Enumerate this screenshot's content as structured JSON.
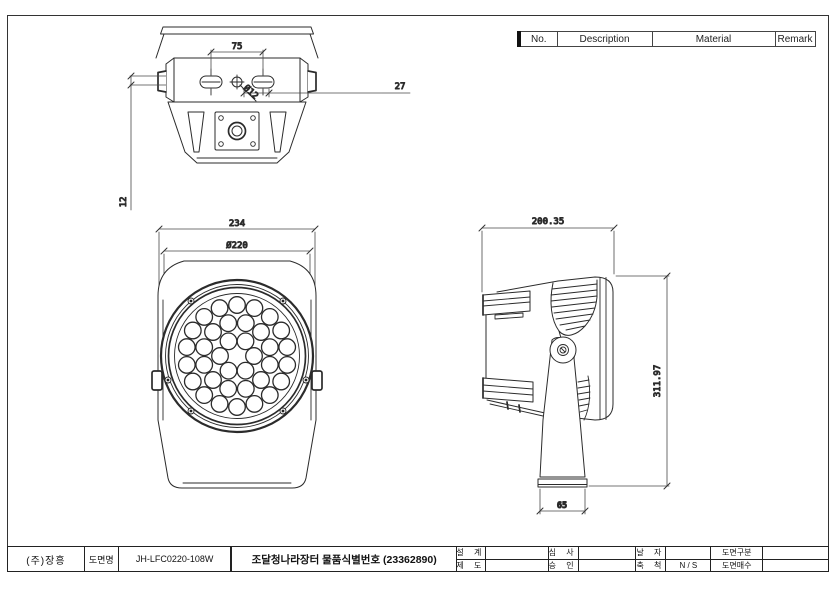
{
  "colors": {
    "line": "#2b2b2b",
    "text": "#111111",
    "background": "#ffffff"
  },
  "spec_table": {
    "columns": [
      "No.",
      "Description",
      "Material",
      "Remark"
    ],
    "rows": [
      {
        "no": "1",
        "description": "Lighting Source",
        "material": "Power LED",
        "remark": ""
      },
      {
        "no": "2",
        "description": "Color Temp",
        "material": "WHITE / MONO / RGB",
        "remark": ""
      },
      {
        "no": "3",
        "description": "Power Consumption",
        "material": "108W",
        "remark": ""
      },
      {
        "no": "4",
        "description": "Input Voltage",
        "material": "DC 24V",
        "remark": ""
      },
      {
        "no": "5",
        "description": "Material",
        "material": "Body - Al. DieCasting",
        "material_line2": "Cover - Tempered Glass",
        "remark": ""
      },
      {
        "no": "6",
        "description": "Dimension",
        "material": "Ø220x200.3(H)x312(L)",
        "remark": ""
      },
      {
        "no": "7",
        "description": "-",
        "material": "-",
        "remark": ""
      },
      {
        "no": "8",
        "description": "-",
        "material": "-",
        "remark": ""
      }
    ]
  },
  "views": {
    "top_view": {
      "dim_slot_spacing": "75",
      "dim_hole": "Ø12",
      "dim_offset": "27",
      "dim_plate": "12"
    },
    "front_view": {
      "dim_overall_width": "234",
      "dim_lens_diameter": "Ø220",
      "led_count": 36,
      "led_rings": [
        {
          "count": 6,
          "radius": 17,
          "start_angle": 60
        },
        {
          "count": 12,
          "radius": 34,
          "start_angle": 15
        },
        {
          "count": 18,
          "radius": 51,
          "start_angle": 90
        }
      ]
    },
    "side_view": {
      "dim_depth": "200.35",
      "dim_height": "311.97",
      "dim_base_width": "65"
    }
  },
  "title_block": {
    "company": "(주)장흥",
    "drawing_name_label": "도면명",
    "drawing_number": "JH-LFC0220-108W",
    "item_title": "조달청나라장터 물품식별번호  (23362890)",
    "design_label": "설 계",
    "draft_label": "제 도",
    "review_label": "심 사",
    "approve_label": "승 인",
    "date_label": "날 자",
    "scale_label": "축 척",
    "scale_value": "N / S",
    "category_label": "도면구분",
    "sheets_label": "도면매수"
  }
}
